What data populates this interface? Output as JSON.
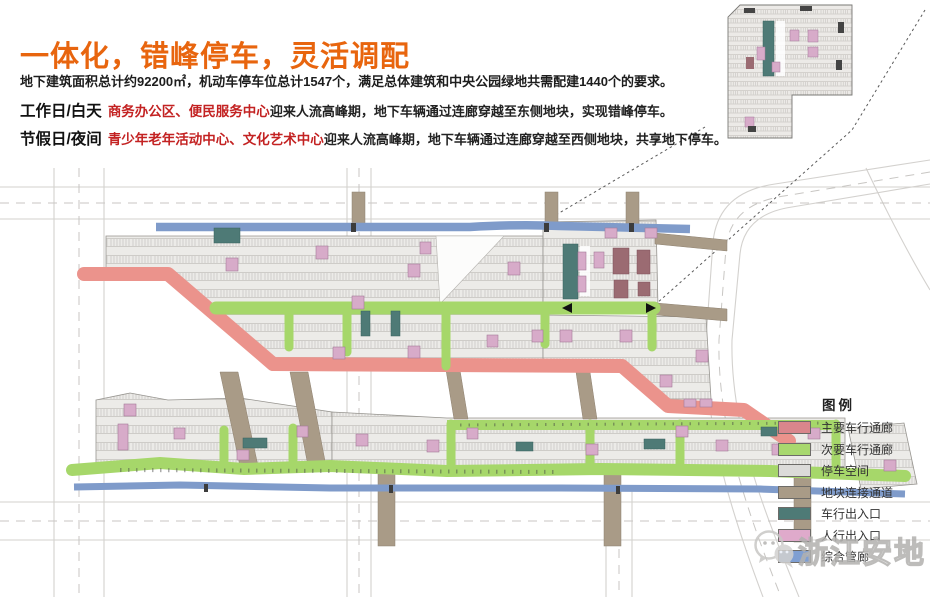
{
  "slide": {
    "title": "一体化，错峰停车，灵活调配",
    "intro": "地下建筑面积总计约92200㎡，机动车停车位总计1547个，满足总体建筑和中央公园绿地共需配建1440个的要求。",
    "schedule": [
      {
        "period": "工作日/白天",
        "highlight": "商务办公区、便民服务中心",
        "description": "迎来人流高峰期，地下车辆通过连廊穿越至东侧地块，实现错峰停车。"
      },
      {
        "period": "节假日/夜间",
        "highlight": "青少年老年活动中心、文化艺术中心",
        "description": "迎来人流高峰期，地下车辆通过连廊穿越至西侧地块，共享地下停车。"
      }
    ]
  },
  "legend": {
    "title": "图例",
    "items": [
      {
        "label": "主要车行通廊",
        "color": "#d9868c"
      },
      {
        "label": "次要车行通廊",
        "color": "#a8d86e"
      },
      {
        "label": "停车空间",
        "color": "#dcdbd9"
      },
      {
        "label": "地块连接通道",
        "color": "#a99b87"
      },
      {
        "label": "车行出入口",
        "color": "#4e7a76"
      },
      {
        "label": "人行出入口",
        "color": "#dfaacb"
      },
      {
        "label": "综合管廊",
        "color": "#7f9fd2"
      }
    ]
  },
  "watermark": {
    "text": "浙江安地"
  },
  "palette": {
    "title_orange": "#e8650e",
    "highlight_red": "#c32222",
    "main_vehicle_corridor": "#eb938c",
    "secondary_vehicle_corridor": "#a6d76a",
    "parking_space": "#ecebe8",
    "plot_connector": "#a99b87",
    "vehicle_entrance": "#4e7a76",
    "pedestrian_entrance": "#d7abc9",
    "utility_corridor": "#7f9bca",
    "road_line": "#d3d1ce"
  }
}
